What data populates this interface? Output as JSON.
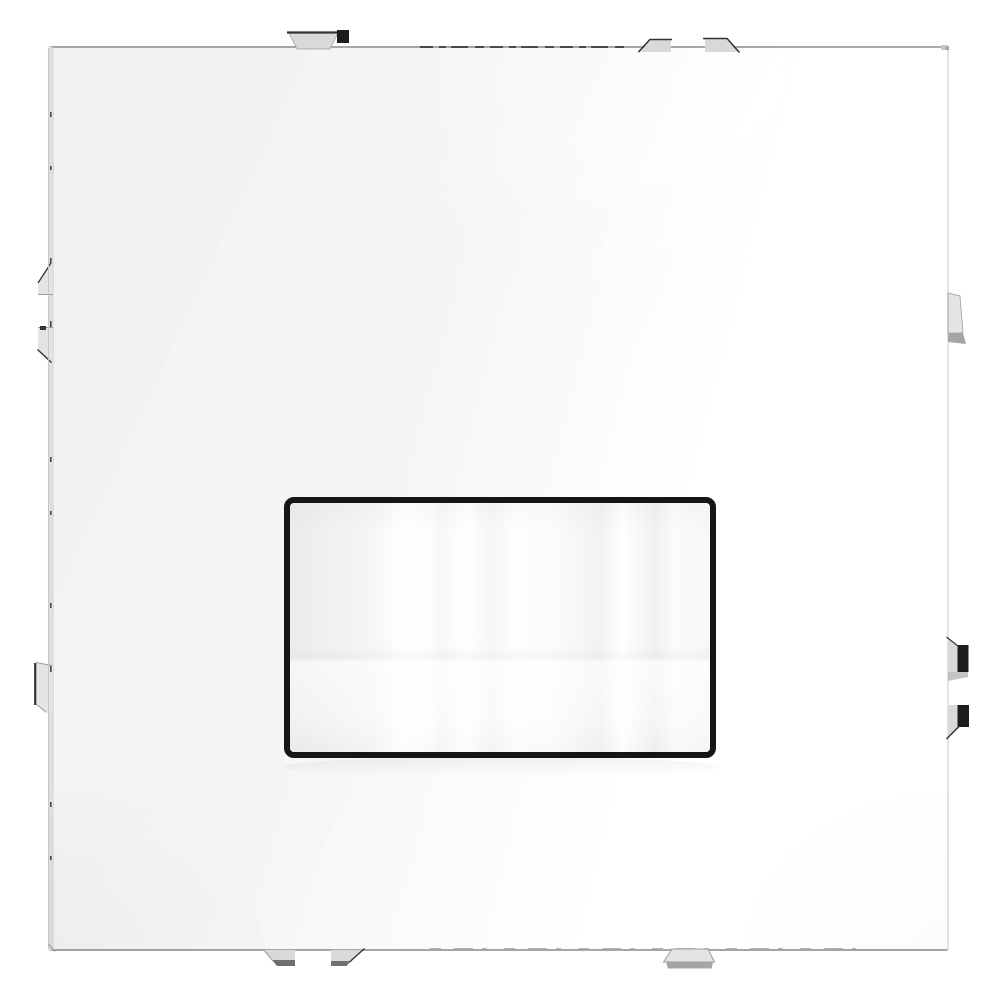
{
  "scene": {
    "description": "Product photo of a glossy white square wall-switch cover plate with gray mounting clips and a central black-framed white button window",
    "background_color": "#ffffff"
  },
  "plate": {
    "surface_color": "#f7f7f7",
    "highlight_color": "#ffffff",
    "top_edge_color": "#a9a9a9",
    "bottom_edge_color": "#a6a6a6",
    "side_face_color": "#e2e2e2",
    "outline_color": "#c6c6c6"
  },
  "center_button": {
    "frame_color": "#151515",
    "face_base_color": "#f4f4f4",
    "face_highlight_color": "#ffffff",
    "face_shade_color": "#ececec"
  },
  "clips": {
    "fill_color": "#d9d9d9",
    "light_fill_color": "#e4e4e4",
    "black_fill_color": "#1d1d1d",
    "shadow_color": "#a5a5a5",
    "dark_gray_color": "#707070",
    "edge_dark_color": "#333333",
    "edge_light_color": "#9c9c9c",
    "corner_mark_color": "#c9c9c9"
  },
  "seams": {
    "tick_color": "#3d3d3d",
    "faint_tick_color": "#9c9c9c"
  }
}
